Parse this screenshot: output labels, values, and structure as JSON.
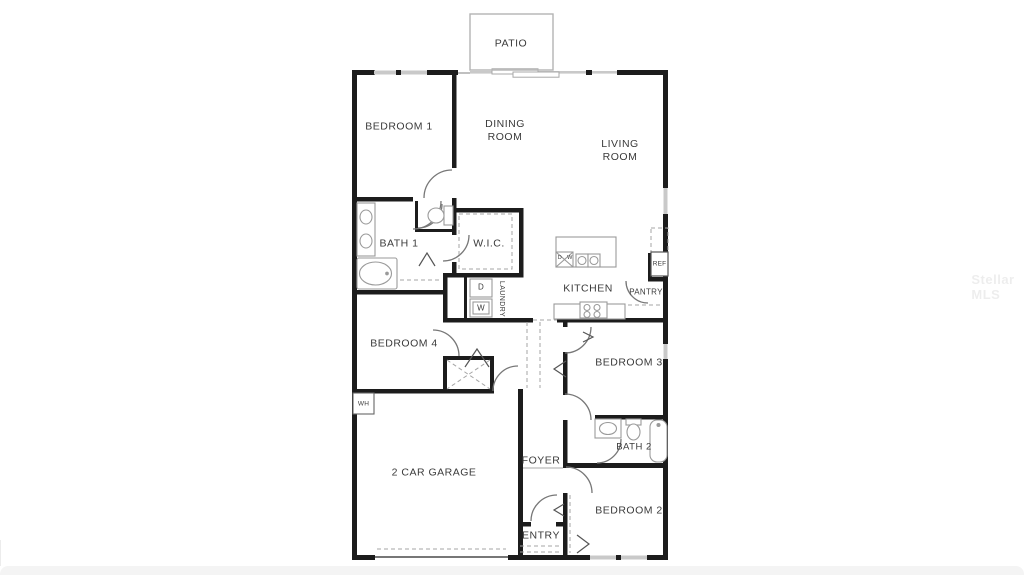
{
  "watermark": "Stellar MLS",
  "floorplan": {
    "rooms": {
      "patio": "PATIO",
      "bedroom1": "BEDROOM 1",
      "dining": "DINING\nROOM",
      "living": "LIVING\nROOM",
      "bath1": "BATH 1",
      "wic": "W.I.C.",
      "kitchen": "KITCHEN",
      "pantry": "PANTRY",
      "laundry": "LAUNDRY",
      "bedroom4": "BEDROOM 4",
      "bedroom3": "BEDROOM 3",
      "bath2": "BATH 2",
      "garage": "2 CAR GARAGE",
      "foyer": "FOYER",
      "entry": "ENTRY",
      "bedroom2": "BEDROOM 2"
    },
    "fixtures": {
      "ref": "REF",
      "wh": "WH",
      "dryer": "D",
      "washer": "W",
      "island_dw_d": "D",
      "island_dw_w": "W"
    },
    "colors": {
      "wall": "#1c1c1c",
      "fixture_line": "#9a9a9a",
      "label_text": "#3a3a3a",
      "window": "#c9c9c9",
      "footer_band": "#f4f4f4"
    }
  }
}
